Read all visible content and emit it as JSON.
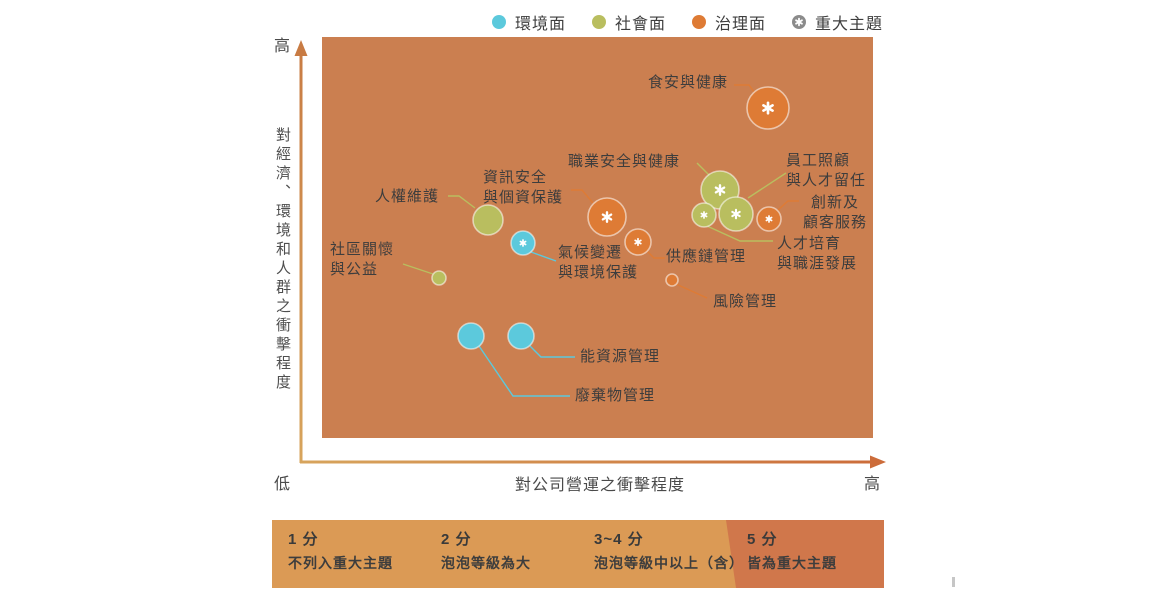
{
  "legend": {
    "items": [
      {
        "id": "environment",
        "label": "環境面",
        "color": "#5CC9DC",
        "marker": "dot"
      },
      {
        "id": "social",
        "label": "社會面",
        "color": "#B9BE5F",
        "marker": "dot"
      },
      {
        "id": "governance",
        "label": "治理面",
        "color": "#DE7B35",
        "marker": "dot"
      },
      {
        "id": "material-topic",
        "label": "重大主題",
        "color": "#8B8B8B",
        "marker": "star-dot"
      }
    ]
  },
  "axes": {
    "y": {
      "title": "對經濟、環境和人群之衝擊程度",
      "top_label": "高",
      "bottom_label": "低"
    },
    "x": {
      "title": "對公司營運之衝擊程度",
      "left_label": "低",
      "right_label": "高"
    }
  },
  "chart_data": {
    "type": "bubble",
    "plot_background": "#CB7F50",
    "x_axis": {
      "title": "對公司營運之衝擊程度",
      "range": [
        "低",
        "高"
      ],
      "scale": "qualitative"
    },
    "y_axis": {
      "title": "對經濟、環境和人群之衝擊程度",
      "range": [
        "低",
        "高"
      ],
      "scale": "qualitative"
    },
    "category_colors": {
      "環境面": "#5CC9DC",
      "社會面": "#B9BE5F",
      "治理面": "#DE7B35"
    },
    "star_meaning": "重大主題",
    "bubbles": [
      {
        "name": "食安與健康",
        "category": "治理面",
        "material": true,
        "size": "large",
        "cx": 768,
        "cy": 108,
        "r": 21,
        "label": {
          "x": 648,
          "y": 73,
          "lines": [
            "食安與健康"
          ]
        },
        "leader": [
          [
            734,
            85
          ],
          [
            749,
            85
          ],
          [
            757,
            96
          ]
        ]
      },
      {
        "name": "職業安全與健康",
        "category": "社會面",
        "material": true,
        "size": "large",
        "cx": 720,
        "cy": 190,
        "r": 19,
        "label": {
          "x": 568,
          "y": 152,
          "lines": [
            "職業安全與健康"
          ]
        },
        "leader": [
          [
            697,
            163
          ],
          [
            711,
            177
          ]
        ]
      },
      {
        "name": "員工照顧與人才留任",
        "category": "社會面",
        "material": true,
        "size": "medium",
        "cx": 736,
        "cy": 214,
        "r": 17,
        "label": {
          "x": 786,
          "y": 151,
          "lines": [
            "員工照顧",
            "與人才留任"
          ]
        },
        "leader": [
          [
            786,
            173
          ],
          [
            748,
            198
          ]
        ]
      },
      {
        "name": "人才培育與職涯發展",
        "category": "社會面",
        "material": true,
        "size": "small",
        "cx": 704,
        "cy": 215,
        "r": 12,
        "label": {
          "x": 777,
          "y": 234,
          "lines": [
            "人才培育",
            "與職涯發展"
          ]
        },
        "leader": [
          [
            707,
            226
          ],
          [
            740,
            241
          ],
          [
            773,
            241
          ]
        ]
      },
      {
        "name": "創新及顧客服務",
        "category": "治理面",
        "material": true,
        "size": "small",
        "cx": 769,
        "cy": 219,
        "r": 12,
        "label": {
          "x": 797,
          "y": 193,
          "lines": [
            "創新及",
            "顧客服務"
          ],
          "align": "center",
          "width": 76
        },
        "leader": [
          [
            778,
            210
          ],
          [
            788,
            201
          ],
          [
            799,
            201
          ]
        ]
      },
      {
        "name": "資訊安全與個資保護",
        "category": "治理面",
        "material": true,
        "size": "large",
        "cx": 607,
        "cy": 217,
        "r": 19,
        "label": {
          "x": 483,
          "y": 168,
          "lines": [
            "資訊安全",
            "與個資保護"
          ]
        },
        "leader": [
          [
            571,
            190
          ],
          [
            582,
            190
          ],
          [
            593,
            203
          ]
        ]
      },
      {
        "name": "供應鏈管理",
        "category": "治理面",
        "material": true,
        "size": "small",
        "cx": 638,
        "cy": 242,
        "r": 13,
        "label": {
          "x": 666,
          "y": 247,
          "lines": [
            "供應鏈管理"
          ]
        },
        "leader": [
          [
            647,
            251
          ],
          [
            654,
            258
          ],
          [
            665,
            258
          ]
        ]
      },
      {
        "name": "氣候變遷與環境保護",
        "category": "環境面",
        "material": true,
        "size": "small",
        "cx": 523,
        "cy": 243,
        "r": 12,
        "label": {
          "x": 558,
          "y": 243,
          "lines": [
            "氣候變遷",
            "與環境保護"
          ]
        },
        "leader": [
          [
            531,
            252
          ],
          [
            556,
            261
          ]
        ]
      },
      {
        "name": "人權維護",
        "category": "社會面",
        "material": false,
        "size": "medium",
        "cx": 488,
        "cy": 220,
        "r": 15,
        "label": {
          "x": 375,
          "y": 187,
          "lines": [
            "人權維護"
          ]
        },
        "leader": [
          [
            448,
            196
          ],
          [
            459,
            196
          ],
          [
            475,
            208
          ]
        ]
      },
      {
        "name": "社區關懷與公益",
        "category": "社會面",
        "material": false,
        "size": "x-small",
        "cx": 439,
        "cy": 278,
        "r": 7,
        "label": {
          "x": 330,
          "y": 240,
          "lines": [
            "社區關懷",
            "與公益"
          ]
        },
        "leader": [
          [
            403,
            264
          ],
          [
            433,
            274
          ]
        ]
      },
      {
        "name": "風險管理",
        "category": "治理面",
        "material": false,
        "size": "x-small",
        "cx": 672,
        "cy": 280,
        "r": 6,
        "label": {
          "x": 713,
          "y": 292,
          "lines": [
            "風險管理"
          ]
        },
        "leader": [
          [
            676,
            284
          ],
          [
            707,
            298
          ]
        ]
      },
      {
        "name": "能資源管理",
        "category": "環境面",
        "material": false,
        "size": "small",
        "cx": 521,
        "cy": 336,
        "r": 13,
        "label": {
          "x": 580,
          "y": 347,
          "lines": [
            "能資源管理"
          ]
        },
        "leader": [
          [
            530,
            346
          ],
          [
            541,
            357
          ],
          [
            575,
            357
          ]
        ]
      },
      {
        "name": "廢棄物管理",
        "category": "環境面",
        "material": false,
        "size": "small",
        "cx": 471,
        "cy": 336,
        "r": 13,
        "label": {
          "x": 575,
          "y": 386,
          "lines": [
            "廢棄物管理"
          ]
        },
        "leader": [
          [
            479,
            346
          ],
          [
            513,
            396
          ],
          [
            570,
            396
          ]
        ]
      }
    ]
  },
  "score_legend": {
    "bar": {
      "light_color": "#DB9A55",
      "dark_color": "#D0774B"
    },
    "segments": [
      {
        "score": "1 分",
        "desc": "不列入重大主題",
        "highlight": false
      },
      {
        "score": "2 分",
        "desc": "泡泡等級為大",
        "highlight": false
      },
      {
        "score": "3~4 分",
        "desc": "泡泡等級中以上（含）",
        "highlight": false
      },
      {
        "score": "5 分",
        "desc": "皆為重大主題",
        "highlight": true
      }
    ]
  }
}
